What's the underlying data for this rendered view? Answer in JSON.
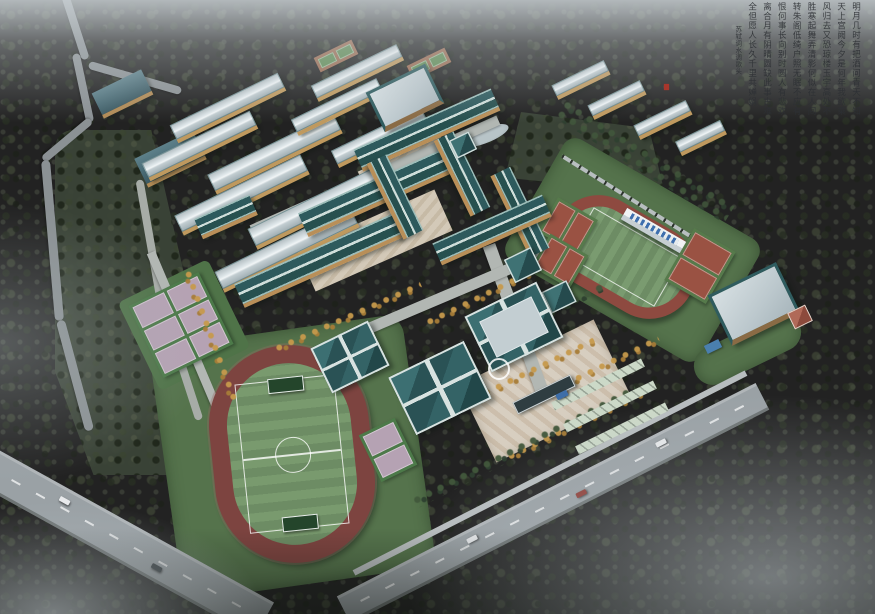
{
  "calligraphy": {
    "poem_title": "水调歌头",
    "poet": "苏轼",
    "columns": [
      "明月几时有把酒问青天不知",
      "天上宫阙今夕是何年我欲乘",
      "风归去又恐琼楼玉宇高处不",
      "胜寒起舞弄清影何似在人间",
      "转朱阁低绮户照无眠不应有",
      "恨何事长向别时圆人有悲欢",
      "离合月有阴晴圆缺此事古难",
      "全但愿人长久千里共婵娟"
    ],
    "attribution": "苏轼词水调歌头",
    "ink_color": "#2d3034",
    "seal_color": "#a8362c"
  },
  "features": {
    "south_track": "running track and football field (south)",
    "north_track": "running track with grandstand (north-east)",
    "grandstand": "grandstand with blue seating",
    "courts_west": "basketball courts (west, purple)",
    "courts_ne": "basketball courts (north-east, red)",
    "courts_north": "courts (north, green)",
    "dormitories": "dormitory blocks with silver roofs",
    "teaching_complex": "teaching buildings with traditional teal roofs",
    "halls": "gymnasium and hall buildings with hip roofs",
    "east_gym": "east building with light roof",
    "entrance": "south entrance gate, plaza and parking",
    "perimeter_road": "perimeter road with cars",
    "mountain_road": "winding mountain road",
    "forest": "forested hillside",
    "mist": "mist and fog overlay",
    "pond": "landscape pond",
    "calligraphy_block": "chinese calligraphy inscription"
  },
  "palette": {
    "fog": "#c6ccd0",
    "forest_dark": "#333a2e",
    "forest_mid": "#4a5243",
    "track_red": "#8e4a40",
    "field_green": "#71905f",
    "roof_teal": "#2f5f62",
    "roof_silver": "#ccd6d9",
    "facade_tan": "#c09a62",
    "court_purple": "#b5a2b3",
    "court_green": "#4c7a49",
    "plaza_tan": "#d7cec0",
    "road_gray": "#9aa1a5",
    "stand_blue": "#3f6fae",
    "tree_autumn": "#c79a4c"
  }
}
